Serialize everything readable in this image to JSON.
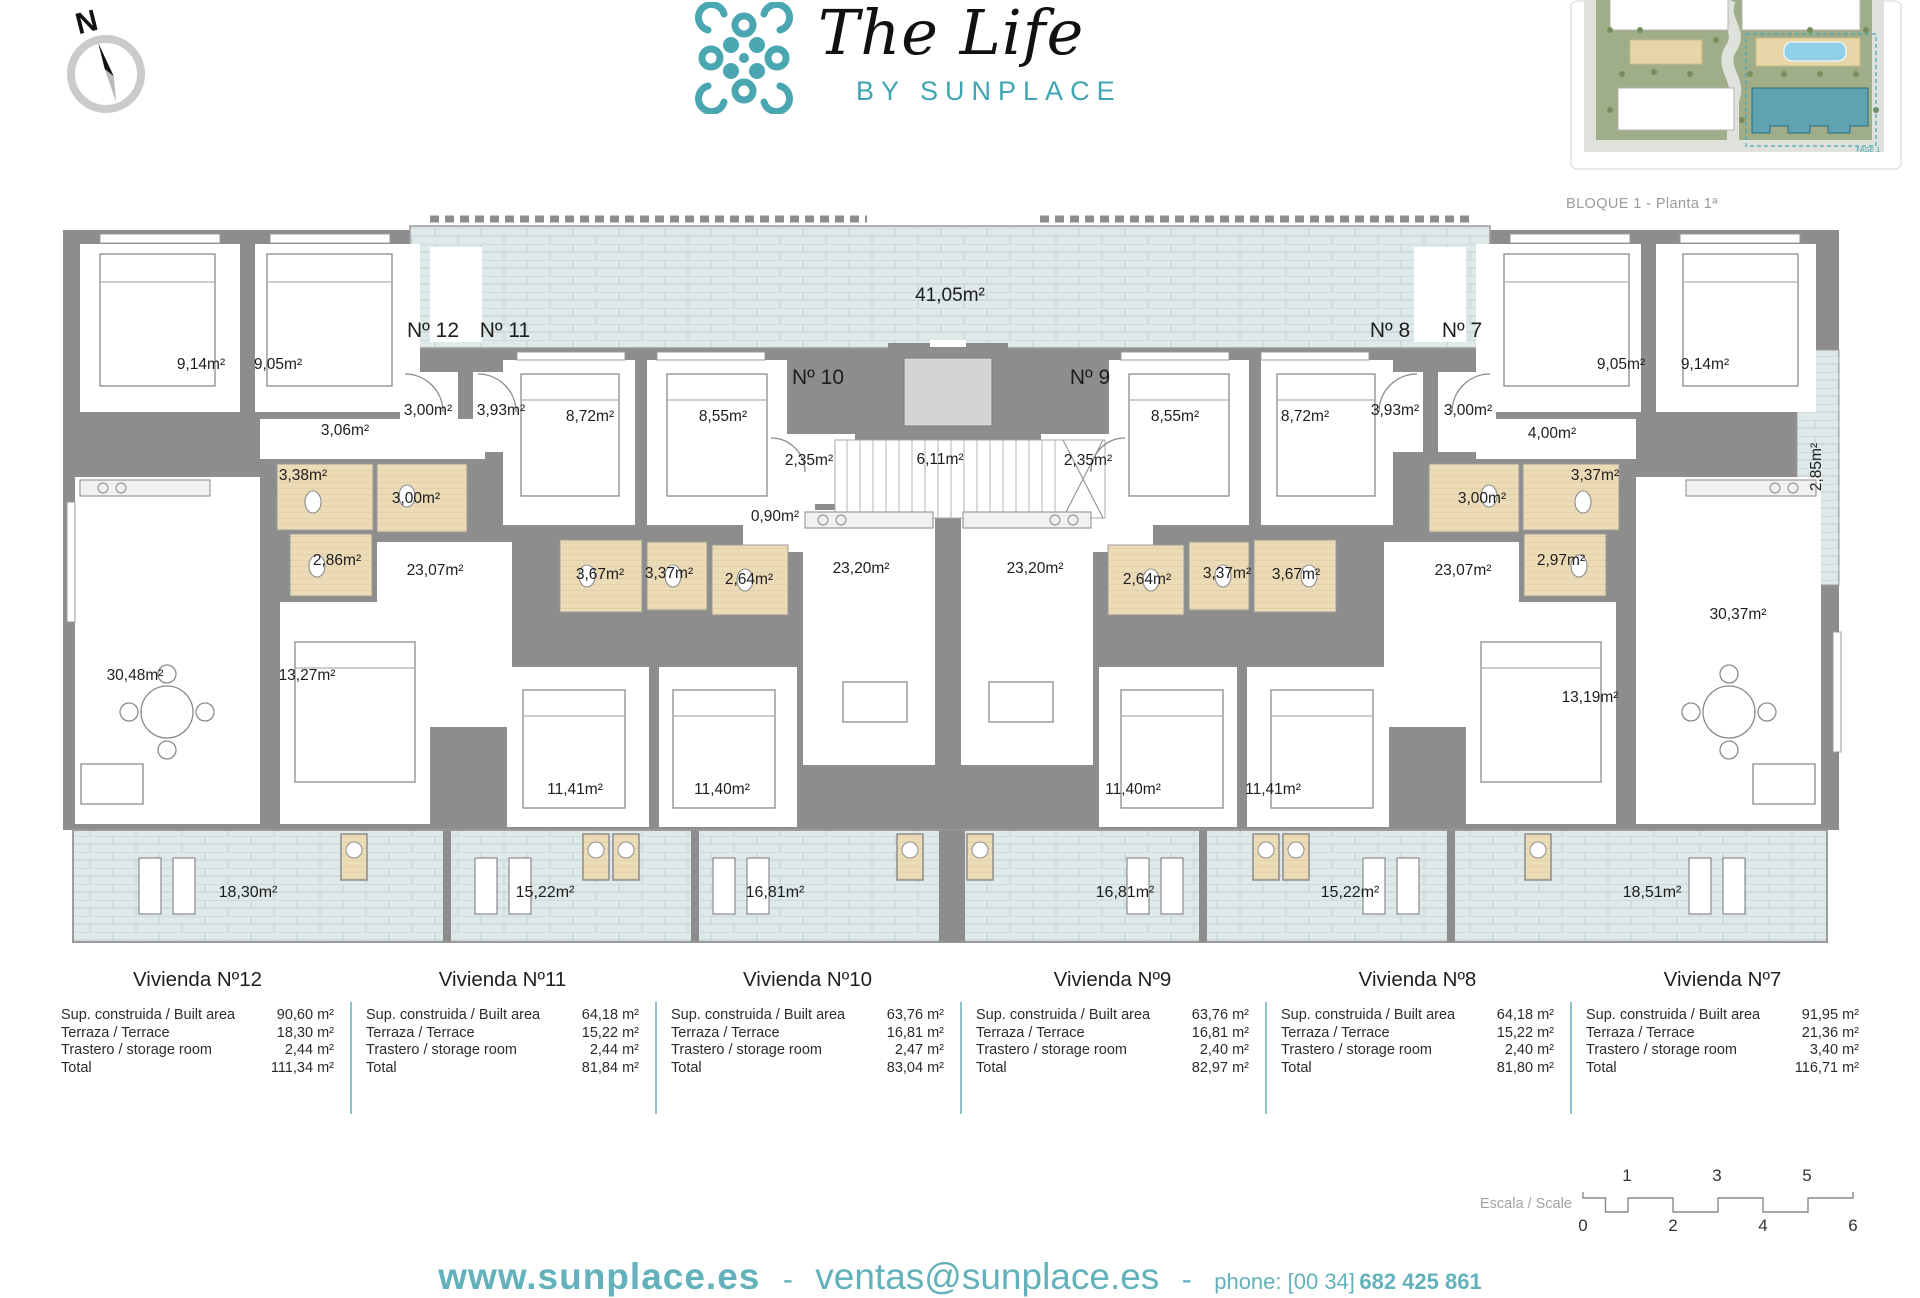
{
  "brand": {
    "title": "The Life",
    "subtitle": "BY SUNPLACE",
    "teal": "#4aa7b2"
  },
  "compass": {
    "label": "N"
  },
  "siteplan": {
    "caption": "BLOQUE 1 - Planta 1ª",
    "fase": "FASE 1"
  },
  "plan": {
    "unit_numbers": [
      {
        "text": "Nº 12",
        "x": 378,
        "y": 119
      },
      {
        "text": "Nº 11",
        "x": 450,
        "y": 119
      },
      {
        "text": "Nº 10",
        "x": 763,
        "y": 166
      },
      {
        "text": "Nº 9",
        "x": 1035,
        "y": 166
      },
      {
        "text": "Nº 8",
        "x": 1335,
        "y": 119
      },
      {
        "text": "Nº 7",
        "x": 1407,
        "y": 119
      }
    ],
    "labels": [
      {
        "text": "41,05m²",
        "x": 895,
        "y": 84,
        "size": 19
      },
      {
        "text": "9,14m²",
        "x": 146,
        "y": 153
      },
      {
        "text": "9,05m²",
        "x": 223,
        "y": 153
      },
      {
        "text": "9,05m²",
        "x": 1566,
        "y": 153
      },
      {
        "text": "9,14m²",
        "x": 1650,
        "y": 153
      },
      {
        "text": "3,00m²",
        "x": 373,
        "y": 199
      },
      {
        "text": "3,93m²",
        "x": 446,
        "y": 199
      },
      {
        "text": "3,93m²",
        "x": 1340,
        "y": 199
      },
      {
        "text": "3,00m²",
        "x": 1413,
        "y": 199
      },
      {
        "text": "3,06m²",
        "x": 290,
        "y": 219
      },
      {
        "text": "4,00m²",
        "x": 1497,
        "y": 222
      },
      {
        "text": "8,72m²",
        "x": 535,
        "y": 205
      },
      {
        "text": "8,55m²",
        "x": 668,
        "y": 205
      },
      {
        "text": "8,55m²",
        "x": 1120,
        "y": 205
      },
      {
        "text": "8,72m²",
        "x": 1250,
        "y": 205
      },
      {
        "text": "2,35m²",
        "x": 754,
        "y": 249
      },
      {
        "text": "6,11m²",
        "x": 885,
        "y": 248
      },
      {
        "text": "2,35m²",
        "x": 1033,
        "y": 249
      },
      {
        "text": "3,38m²",
        "x": 248,
        "y": 264
      },
      {
        "text": "3,37m²",
        "x": 1540,
        "y": 264
      },
      {
        "text": "3,00m²",
        "x": 361,
        "y": 287
      },
      {
        "text": "3,00m²",
        "x": 1427,
        "y": 287
      },
      {
        "text": "0,90m²",
        "x": 720,
        "y": 305
      },
      {
        "text": "2,86m²",
        "x": 282,
        "y": 349
      },
      {
        "text": "2,97m²",
        "x": 1506,
        "y": 349
      },
      {
        "text": "3,67m²",
        "x": 545,
        "y": 363
      },
      {
        "text": "3,37m²",
        "x": 614,
        "y": 362
      },
      {
        "text": "2,64m²",
        "x": 694,
        "y": 368
      },
      {
        "text": "2,64m²",
        "x": 1092,
        "y": 368
      },
      {
        "text": "3,37m²",
        "x": 1172,
        "y": 362
      },
      {
        "text": "3,67m²",
        "x": 1241,
        "y": 363
      },
      {
        "text": "23,20m²",
        "x": 806,
        "y": 357
      },
      {
        "text": "23,20m²",
        "x": 980,
        "y": 357
      },
      {
        "text": "23,07m²",
        "x": 380,
        "y": 359
      },
      {
        "text": "23,07m²",
        "x": 1408,
        "y": 359
      },
      {
        "text": "30,48m²",
        "x": 80,
        "y": 464
      },
      {
        "text": "13,27m²",
        "x": 252,
        "y": 464
      },
      {
        "text": "13,19m²",
        "x": 1535,
        "y": 486
      },
      {
        "text": "30,37m²",
        "x": 1683,
        "y": 403
      },
      {
        "text": "2,85m²",
        "x": 1762,
        "y": 255,
        "rot": -90
      },
      {
        "text": "11,41m²",
        "x": 520,
        "y": 578
      },
      {
        "text": "11,40m²",
        "x": 667,
        "y": 578
      },
      {
        "text": "11,40m²",
        "x": 1078,
        "y": 578
      },
      {
        "text": "11,41m²",
        "x": 1218,
        "y": 578
      },
      {
        "text": "18,30m²",
        "x": 193,
        "y": 681,
        "size": 16
      },
      {
        "text": "15,22m²",
        "x": 490,
        "y": 681,
        "size": 16
      },
      {
        "text": "16,81m²",
        "x": 720,
        "y": 681,
        "size": 16
      },
      {
        "text": "16,81m²",
        "x": 1070,
        "y": 681,
        "size": 16
      },
      {
        "text": "15,22m²",
        "x": 1295,
        "y": 681,
        "size": 16
      },
      {
        "text": "18,51m²",
        "x": 1597,
        "y": 681,
        "size": 16
      }
    ]
  },
  "units": [
    {
      "name": "Vivienda Nº12",
      "rows": [
        {
          "label": "Sup. construida / Built area",
          "value": "90,60 m²"
        },
        {
          "label": "Terraza / Terrace",
          "value": "18,30 m²"
        },
        {
          "label": "Trastero / storage room",
          "value": "2,44 m²"
        },
        {
          "label": "Total",
          "value": "111,34 m²"
        }
      ]
    },
    {
      "name": "Vivienda Nº11",
      "rows": [
        {
          "label": "Sup. construida / Built area",
          "value": "64,18 m²"
        },
        {
          "label": "Terraza / Terrace",
          "value": "15,22 m²"
        },
        {
          "label": "Trastero / storage room",
          "value": "2,44 m²"
        },
        {
          "label": "Total",
          "value": "81,84 m²"
        }
      ]
    },
    {
      "name": "Vivienda Nº10",
      "rows": [
        {
          "label": "Sup. construida / Built area",
          "value": "63,76 m²"
        },
        {
          "label": "Terraza / Terrace",
          "value": "16,81 m²"
        },
        {
          "label": "Trastero / storage room",
          "value": "2,47 m²"
        },
        {
          "label": "Total",
          "value": "83,04 m²"
        }
      ]
    },
    {
      "name": "Vivienda Nº9",
      "rows": [
        {
          "label": "Sup. construida / Built area",
          "value": "63,76 m²"
        },
        {
          "label": "Terraza / Terrace",
          "value": "16,81 m²"
        },
        {
          "label": "Trastero / storage room",
          "value": "2,40 m²"
        },
        {
          "label": "Total",
          "value": "82,97 m²"
        }
      ]
    },
    {
      "name": "Vivienda Nº8",
      "rows": [
        {
          "label": "Sup. construida / Built area",
          "value": "64,18 m²"
        },
        {
          "label": "Terraza / Terrace",
          "value": "15,22 m²"
        },
        {
          "label": "Trastero / storage room",
          "value": "2,40 m²"
        },
        {
          "label": "Total",
          "value": "81,80 m²"
        }
      ]
    },
    {
      "name": "Vivienda Nº7",
      "rows": [
        {
          "label": "Sup. construida / Built area",
          "value": "91,95 m²"
        },
        {
          "label": "Terraza / Terrace",
          "value": "21,36 m²"
        },
        {
          "label": "Trastero / storage room",
          "value": "3,40 m²"
        },
        {
          "label": "Total",
          "value": "116,71 m²"
        }
      ]
    }
  ],
  "scale": {
    "label": "Escala / Scale",
    "numbers": [
      {
        "text": "1",
        "x": 147,
        "y": 16
      },
      {
        "text": "3",
        "x": 237,
        "y": 16
      },
      {
        "text": "5",
        "x": 327,
        "y": 16
      },
      {
        "text": "0",
        "x": 103,
        "y": 66
      },
      {
        "text": "2",
        "x": 193,
        "y": 66
      },
      {
        "text": "4",
        "x": 283,
        "y": 66
      },
      {
        "text": "6",
        "x": 373,
        "y": 66
      }
    ]
  },
  "footer": {
    "website": "www.sunplace.es",
    "separator": "-",
    "email": "ventas@sunplace.es",
    "phone_label": "phone: [00 34]",
    "phone_number": "682 425 861"
  }
}
